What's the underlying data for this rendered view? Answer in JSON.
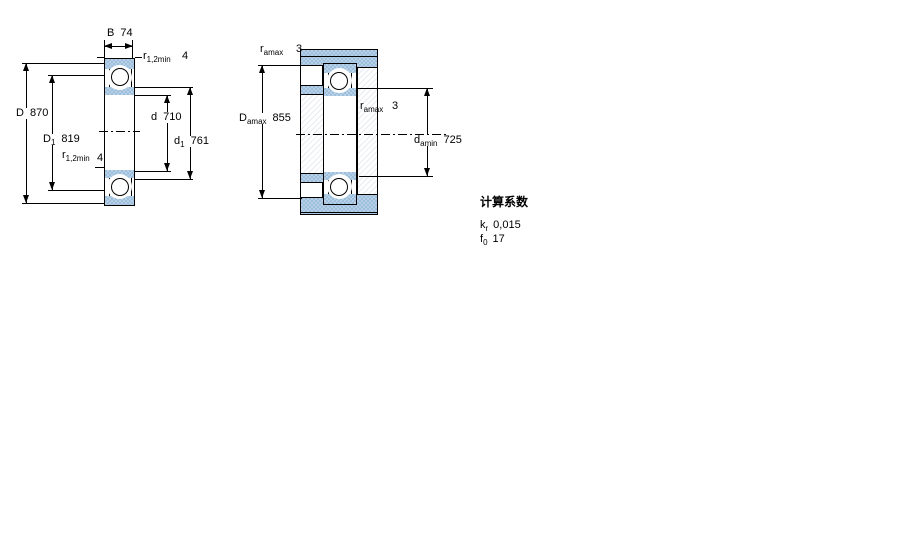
{
  "left_figure": {
    "B": {
      "base": "B",
      "sub": "",
      "val": "74"
    },
    "r_top": {
      "base": "r",
      "sub": "1,2min",
      "val": "4"
    },
    "D": {
      "base": "D",
      "sub": "",
      "val": "870"
    },
    "D1": {
      "base": "D",
      "sub": "1",
      "val": "819"
    },
    "r_mid": {
      "base": "r",
      "sub": "1,2min",
      "val": "4"
    },
    "d": {
      "base": "d",
      "sub": "",
      "val": "710"
    },
    "d1": {
      "base": "d",
      "sub": "1",
      "val": "761"
    }
  },
  "middle_figure": {
    "r_amax_top": {
      "base": "r",
      "sub": "amax",
      "val": "3"
    },
    "D_amax": {
      "base": "D",
      "sub": "amax",
      "val": "855"
    },
    "r_amax_right": {
      "base": "r",
      "sub": "amax",
      "val": "3"
    },
    "d_amin": {
      "base": "d",
      "sub": "amin",
      "val": "725"
    }
  },
  "calculation_factors": {
    "title": "计算系数",
    "kr": {
      "base": "k",
      "sub": "r",
      "val": "0,015"
    },
    "f0": {
      "base": "f",
      "sub": "0",
      "val": "17"
    }
  },
  "colors": {
    "ring_fill": "#a9c6e0",
    "line": "#000000",
    "background": "#ffffff"
  }
}
